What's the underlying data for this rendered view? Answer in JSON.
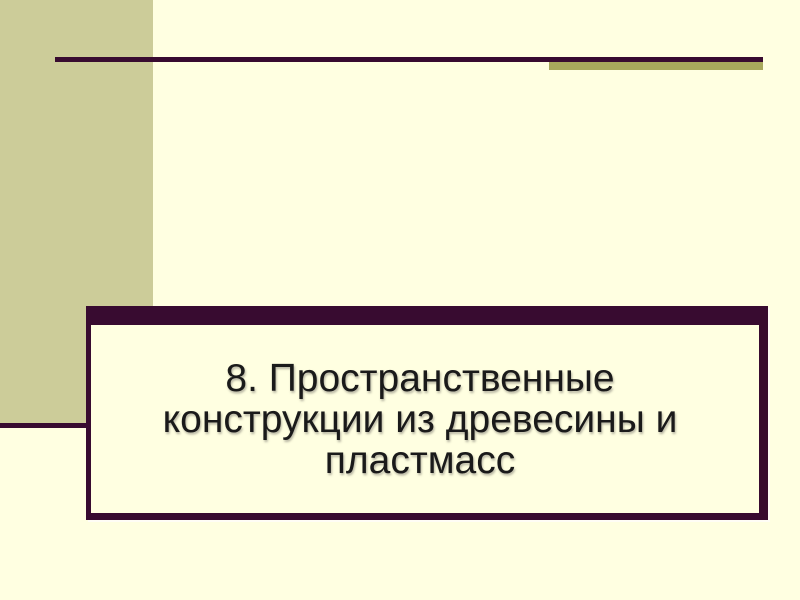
{
  "slide": {
    "type": "presentation-title-slide",
    "title": {
      "lines": {
        "0": "8. Пространственные",
        "1": "конструкции из древесины и",
        "2": "пластмасс"
      },
      "full": "8. Пространственные конструкции из древесины и пластмасс"
    },
    "colors": {
      "background": "#FFFFE1",
      "left_band_olive": "#CCCC99",
      "accent_bar_olive": "#A8A85C",
      "accent_purple": "#380B30",
      "title_text": "#1A1A1A"
    }
  }
}
